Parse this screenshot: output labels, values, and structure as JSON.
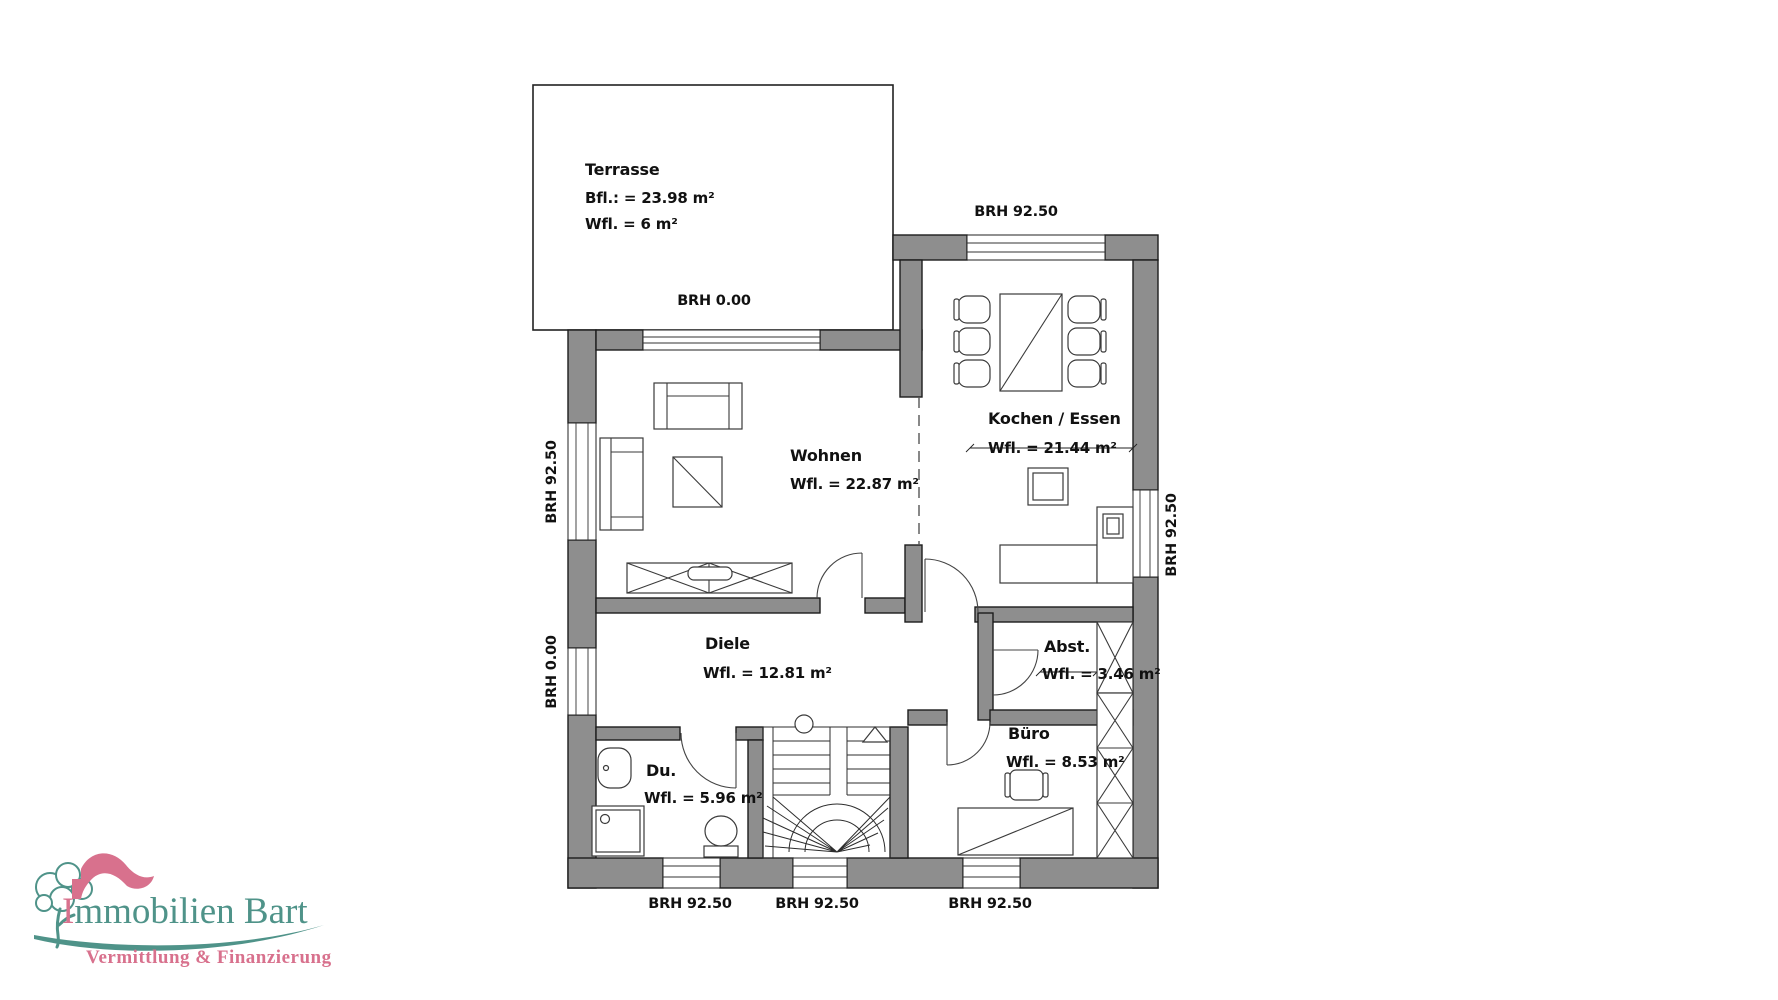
{
  "plan": {
    "terrasse": {
      "name": "Terrasse",
      "bfl": "Bfl.: = 23.98 m²",
      "wfl": "Wfl. = 6 m²",
      "brh": "BRH 0.00"
    },
    "wohnen": {
      "name": "Wohnen",
      "wfl": "Wfl. = 22.87 m²"
    },
    "kochen": {
      "name": "Kochen / Essen",
      "wfl": "Wfl. = 21.44 m²"
    },
    "diele": {
      "name": "Diele",
      "wfl": "Wfl. = 12.81 m²"
    },
    "abst": {
      "name": "Abst.",
      "wfl": "Wfl. = 3.46 m²"
    },
    "buero": {
      "name": "Büro",
      "wfl": "Wfl. = 8.53 m²"
    },
    "du": {
      "name": "Du.",
      "wfl": "Wfl. = 5.96 m²"
    },
    "brh": {
      "top": "BRH 92.50",
      "left_upper": "BRH 92.50",
      "left_lower": "BRH 0.00",
      "right": "BRH 92.50",
      "bottom_left": "BRH 92.50",
      "bottom_center": "BRH 92.50",
      "bottom_right": "BRH 92.50"
    }
  },
  "logo": {
    "company": "Immobilien Bart",
    "tagline": "Vermittlung & Finanzierung"
  },
  "colors": {
    "teal": "#4f9389",
    "pink": "#d8718d",
    "wall": "#8e8e8e"
  }
}
